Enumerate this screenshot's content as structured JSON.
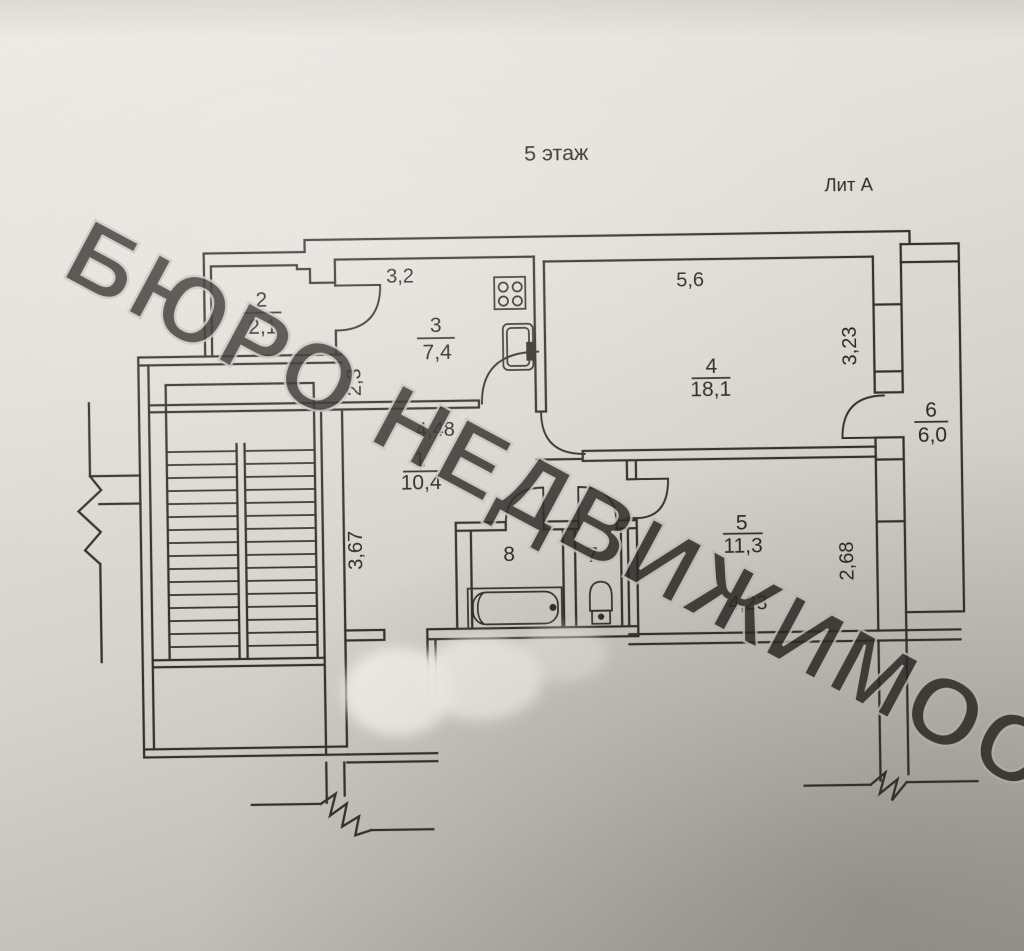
{
  "plan": {
    "title": "5 этаж",
    "liter": "Лит А",
    "watermark": "БЮРО НЕДВИЖИМОСТИ",
    "ink_color": "#34312c",
    "paper_color": "#ddd9d2",
    "rooms": {
      "r1": {
        "num": "1",
        "area": "10,4"
      },
      "r2": {
        "num": "2",
        "area": "2,1"
      },
      "r3": {
        "num": "3",
        "area": "7,4"
      },
      "r4": {
        "num": "4",
        "area": "18,1"
      },
      "r5": {
        "num": "5",
        "area": "11,3"
      },
      "r6": {
        "num": "6",
        "area": "6,0"
      },
      "r7": {
        "num": "7"
      },
      "r8": {
        "num": "8"
      }
    },
    "dims": {
      "kitchen_top": "3,2",
      "kitchen_left": "2,3",
      "room4_top": "5,6",
      "room4_right": "3,23",
      "hall_top": "4,48",
      "hall_left": "3,67",
      "room5_right": "2,68",
      "room5_bottom": "4,23"
    }
  }
}
